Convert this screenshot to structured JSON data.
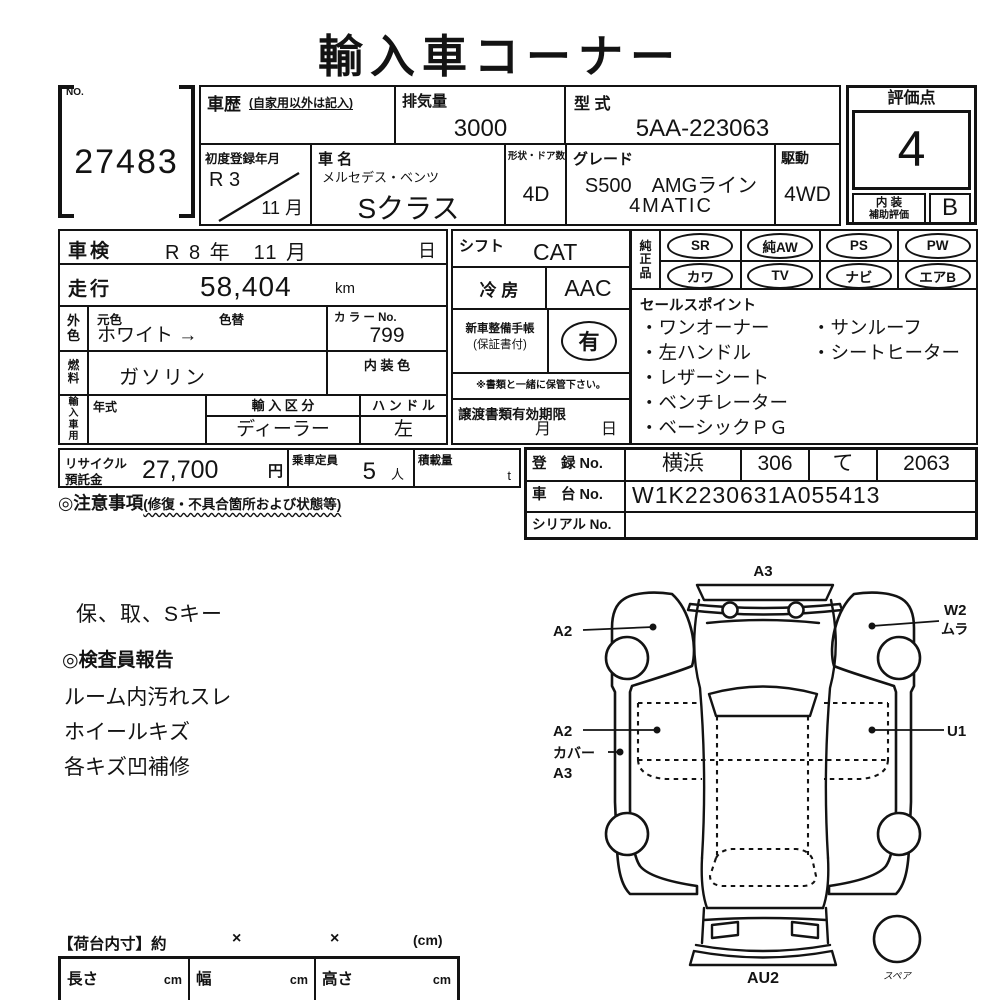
{
  "title": "輸入車コーナー",
  "colors": {
    "ink": "#131313",
    "paper": "#ffffff"
  },
  "top": {
    "no_label": "NO.",
    "no_value": "27483",
    "history_label": "車歴",
    "history_note": "(自家用以外は記入)",
    "displacement_label": "排気量",
    "displacement_value": "3000",
    "model_code_label": "型  式",
    "model_code_value": "5AA-223063",
    "first_reg_label": "初度登録年月",
    "first_reg_year": "R 3",
    "first_reg_month": "11 月",
    "name_label": "車  名",
    "maker": "メルセデス・ベンツ",
    "model": "Sクラス",
    "shape_doors_label": "形状・ドア数",
    "shape_doors_value": "4D",
    "grade_label": "グレード",
    "grade_line1": "S500　AMGライン",
    "grade_line2": "4MATIC",
    "drive_label": "駆動",
    "drive_value": "4WD",
    "score_label": "評価点",
    "score_value": "4",
    "interior_grade_label_1": "内 装",
    "interior_grade_label_2": "補助評価",
    "interior_grade_value": "B"
  },
  "left": {
    "shaken_label": "車検",
    "shaken_value": "R 8 年　11 月",
    "shaken_day": "日",
    "mileage_label": "走行",
    "mileage_value": "58,404",
    "mileage_unit": "km",
    "ext_color_label": "外色",
    "base_color_label": "元色",
    "repaint_label": "色替",
    "color_value": "ホワイト →",
    "color_no_label": "カ ラ ー No.",
    "color_no_value": "799",
    "fuel_label": "燃料",
    "fuel_value": "ガソリン",
    "interior_color_label": "内 装 色",
    "import_use_label": "輸入車用",
    "year_label": "年式",
    "import_class_label": "輸 入 区 分",
    "import_class_value": "ディーラー",
    "handle_label": "ハ ン ド ル",
    "handle_value": "左"
  },
  "center": {
    "shift_label": "シフト",
    "shift_value": "CAT",
    "ac_label": "冷  房",
    "ac_value": "AAC",
    "service_book_label": "新車整備手帳",
    "service_book_sub": "(保証書付)",
    "service_book_value": "有",
    "service_note": "※書類と一緒に保管下さい。",
    "transfer_label": "譲渡書類有効期限",
    "transfer_month": "月",
    "transfer_day": "日"
  },
  "right": {
    "oem_label": "純正品",
    "oem_items": [
      "SR",
      "純AW",
      "PS",
      "PW",
      "カワ",
      "TV",
      "ナビ",
      "エアB"
    ],
    "sales_label": "セールスポイント",
    "sales_rows": [
      [
        "・ワンオーナー",
        "・サンルーフ"
      ],
      [
        "・左ハンドル",
        "・シートヒーター"
      ],
      [
        "・レザーシート",
        ""
      ],
      [
        "・ベンチレーター",
        ""
      ],
      [
        "・ベーシックＰＧ",
        ""
      ]
    ]
  },
  "bottom": {
    "recycle_label_1": "リサイクル",
    "recycle_label_2": "預託金",
    "recycle_value": "27,700",
    "recycle_unit": "円",
    "capacity_label": "乗車定員",
    "capacity_value": "5",
    "capacity_unit": "人",
    "load_label": "積載量",
    "load_unit": "t",
    "caution_label": "◎注意事項",
    "caution_note": "(修復・不具合箇所および状態等)",
    "reg_no_label": "登　録 No.",
    "reg_no_area": "横浜",
    "reg_no_class": "306",
    "reg_no_kana": "て",
    "reg_no_number": "2063",
    "chassis_label": "車　台 No.",
    "chassis_value": "W1K2230631A055413",
    "serial_label": "シリアル No."
  },
  "notes": {
    "keys_line": "保、取、Sキー",
    "inspector_title": "◎検査員報告",
    "items": [
      "ルーム内汚れスレ",
      "ホイールキズ",
      "各キズ凹補修"
    ]
  },
  "diagram": {
    "label_front": "A3",
    "label_left_fender": "A2",
    "label_right_fender_1": "W2",
    "label_right_fender_2": "ムラ",
    "label_left_door": "A2",
    "label_cover_1": "カバー",
    "label_cover_2": "A3",
    "label_right_door": "U1",
    "label_rear": "AU2",
    "label_spare": "スペア"
  },
  "cargo": {
    "title": "【荷台内寸】約",
    "times_1": "×",
    "times_2": "×",
    "unit_note": "(cm)",
    "length_label": "長さ",
    "length_unit": "cm",
    "width_label": "幅",
    "width_unit": "cm",
    "height_label": "高さ",
    "height_unit": "cm"
  }
}
